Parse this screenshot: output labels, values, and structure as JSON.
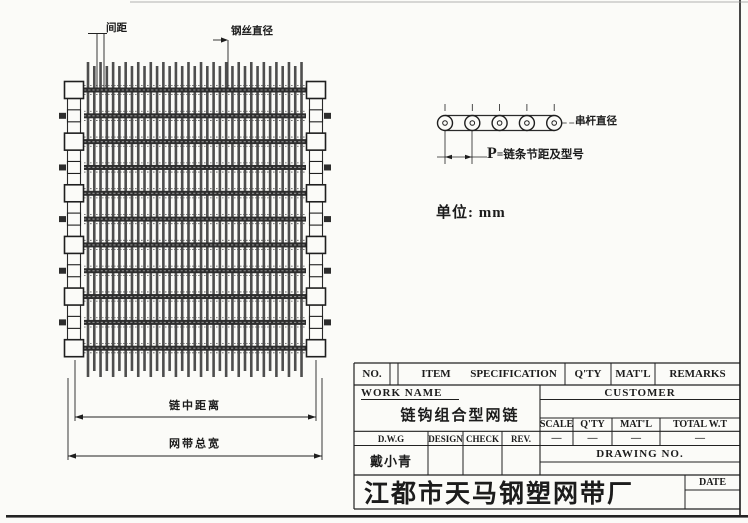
{
  "page": {
    "unit_note": "单位: mm"
  },
  "belt": {
    "label_pitch": "间距",
    "label_wire_diameter": "钢丝直径",
    "label_chain_center_distance": "链中距离",
    "label_total_width": "网带总宽",
    "wire_count": 35,
    "rod_count": 11
  },
  "chain_detail": {
    "label_rod_diameter": "串杆直径",
    "label_pitch_formula": "P=链条节距及型号",
    "roller_count": 5
  },
  "title_block": {
    "no": "NO.",
    "item": "ITEM",
    "specification": "SPECIFICATION",
    "qty": "Q'TY",
    "matl": "MAT'L",
    "remarks": "REMARKS",
    "work_name_label": "WORK NAME",
    "work_name_value": "链钩组合型网链",
    "customer_label": "CUSTOMER",
    "scale": "SCALE",
    "qty2": "Q'TY",
    "matl2": "MAT'L",
    "total_wt": "TOTAL W.T",
    "scale_val": "—",
    "qty_val": "—",
    "matl_val": "—",
    "total_wt_val": "—",
    "dwg": "D.W.G",
    "design": "DESIGN",
    "check": "CHECK",
    "rev": "REV.",
    "dwg_name": "戴小青",
    "drawing_no": "DRAWING NO.",
    "date": "DATE",
    "company": "江都市天马钢塑网带厂"
  }
}
